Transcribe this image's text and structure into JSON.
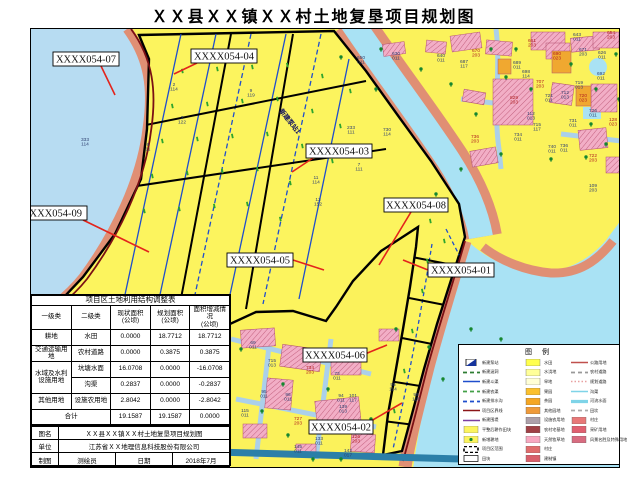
{
  "title": "ＸＸ县ＸＸ镇ＸＸ村土地复垦项目规划图",
  "map": {
    "rotated_note": {
      "text": "新建泵站1",
      "x": 248,
      "y": 82,
      "rot": 52
    },
    "parcel_labels": [
      {
        "text": "XXXX054-07",
        "x": 22,
        "y": 23,
        "w": 66,
        "h": 14,
        "lx1": 70,
        "ly1": 37,
        "lx2": 84,
        "ly2": 66
      },
      {
        "text": "XXXX054-04",
        "x": 160,
        "y": 20,
        "w": 66,
        "h": 14,
        "lx1": 166,
        "ly1": 34,
        "lx2": 143,
        "ly2": 45
      },
      {
        "text": "XXXX054-09",
        "x": -14,
        "y": 177,
        "w": 70,
        "h": 14,
        "lx1": 52,
        "ly1": 191,
        "lx2": 118,
        "ly2": 223
      },
      {
        "text": "XXXX054-03",
        "x": 275,
        "y": 115,
        "w": 66,
        "h": 14,
        "lx1": 282,
        "ly1": 129,
        "lx2": 261,
        "ly2": 143
      },
      {
        "text": "XXXX054-08",
        "x": 353,
        "y": 169,
        "w": 64,
        "h": 14,
        "lx1": 380,
        "ly1": 183,
        "lx2": 348,
        "ly2": 236
      },
      {
        "text": "XXXX054-05",
        "x": 196,
        "y": 224,
        "w": 66,
        "h": 14,
        "lx1": 262,
        "ly1": 231,
        "lx2": 293,
        "ly2": 241
      },
      {
        "text": "XXXX054-01",
        "x": 397,
        "y": 234,
        "w": 66,
        "h": 14,
        "lx1": 397,
        "ly1": 241,
        "lx2": 372,
        "ly2": 231
      },
      {
        "text": "XXXX054-06",
        "x": 272,
        "y": 319,
        "w": 64,
        "h": 14,
        "lx1": 334,
        "ly1": 325,
        "lx2": 356,
        "ly2": 316
      },
      {
        "text": "XXXX054-02",
        "x": 278,
        "y": 391,
        "w": 64,
        "h": 14,
        "lx1": 340,
        "ly1": 392,
        "lx2": 371,
        "ly2": 374
      }
    ],
    "annotations": [
      {
        "x": 54,
        "y": 112,
        "t": "333",
        "b": "114"
      },
      {
        "x": 143,
        "y": 57,
        "t": "2",
        "b": "114"
      },
      {
        "x": 151,
        "y": 90,
        "t": "3",
        "b": "122"
      },
      {
        "x": 117,
        "y": 117,
        "t": "6",
        "b": "11"
      },
      {
        "x": 220,
        "y": 63,
        "t": "9",
        "b": "119"
      },
      {
        "x": 320,
        "y": 100,
        "t": "233",
        "b": "111"
      },
      {
        "x": 328,
        "y": 137,
        "t": "7",
        "b": "111"
      },
      {
        "x": 356,
        "y": 102,
        "t": "730",
        "b": "114"
      },
      {
        "x": 285,
        "y": 150,
        "t": "11",
        "b": "114"
      },
      {
        "x": 287,
        "y": 172,
        "t": "13",
        "b": "152"
      },
      {
        "x": 330,
        "y": 30,
        "t": "650",
        "b": "011"
      },
      {
        "x": 365,
        "y": 26,
        "t": "630",
        "b": "011"
      },
      {
        "x": 410,
        "y": 28,
        "t": "640",
        "b": "011"
      },
      {
        "x": 222,
        "y": 315,
        "t": "69",
        "b": "011"
      },
      {
        "x": 241,
        "y": 333,
        "t": "715",
        "b": "013"
      },
      {
        "x": 279,
        "y": 340,
        "t": "734",
        "b": "203",
        "c": "r"
      },
      {
        "x": 306,
        "y": 346,
        "t": "73",
        "b": "011"
      },
      {
        "x": 233,
        "y": 364,
        "t": "95",
        "b": "011"
      },
      {
        "x": 257,
        "y": 367,
        "t": "96",
        "b": "011"
      },
      {
        "x": 214,
        "y": 383,
        "t": "115",
        "b": "011"
      },
      {
        "x": 267,
        "y": 391,
        "t": "727",
        "b": "203",
        "c": "r"
      },
      {
        "x": 288,
        "y": 411,
        "t": "133",
        "b": "011"
      },
      {
        "x": 267,
        "y": 419,
        "t": "145",
        "b": "011"
      },
      {
        "x": 317,
        "y": 423,
        "t": "142",
        "b": "017"
      },
      {
        "x": 312,
        "y": 379,
        "t": "139",
        "b": "013"
      },
      {
        "x": 322,
        "y": 368,
        "t": "101",
        "b": "117"
      },
      {
        "x": 310,
        "y": 368,
        "t": "94",
        "b": "011"
      },
      {
        "x": 325,
        "y": 409,
        "t": "126",
        "b": "203",
        "c": "r"
      },
      {
        "x": 362,
        "y": 357,
        "t": "95",
        "b": "114"
      },
      {
        "x": 385,
        "y": 367,
        "t": "98",
        "b": "118"
      },
      {
        "x": 546,
        "y": 7,
        "t": "643",
        "b": "011"
      },
      {
        "x": 580,
        "y": 5,
        "t": "654",
        "b": "203",
        "c": "r"
      },
      {
        "x": 501,
        "y": 13,
        "t": "661",
        "b": "203",
        "c": "r"
      },
      {
        "x": 445,
        "y": 23,
        "t": "670",
        "b": "203",
        "c": "r"
      },
      {
        "x": 526,
        "y": 26,
        "t": "690",
        "b": "023",
        "c": "r"
      },
      {
        "x": 552,
        "y": 22,
        "t": "671",
        "b": "203"
      },
      {
        "x": 571,
        "y": 25,
        "t": "626",
        "b": "011"
      },
      {
        "x": 433,
        "y": 34,
        "t": "687",
        "b": "117"
      },
      {
        "x": 486,
        "y": 35,
        "t": "689",
        "b": "011"
      },
      {
        "x": 495,
        "y": 44,
        "t": "698",
        "b": "114"
      },
      {
        "x": 570,
        "y": 46,
        "t": "692",
        "b": "011"
      },
      {
        "x": 509,
        "y": 54,
        "t": "707",
        "b": "203",
        "c": "r"
      },
      {
        "x": 548,
        "y": 55,
        "t": "719",
        "b": "013"
      },
      {
        "x": 552,
        "y": 68,
        "t": "720",
        "b": "023",
        "c": "r"
      },
      {
        "x": 518,
        "y": 68,
        "t": "721",
        "b": "011"
      },
      {
        "x": 534,
        "y": 65,
        "t": "712",
        "b": "013"
      },
      {
        "x": 483,
        "y": 70,
        "t": "829",
        "b": "203",
        "c": "r"
      },
      {
        "x": 562,
        "y": 83,
        "t": "726",
        "b": "011"
      },
      {
        "x": 542,
        "y": 93,
        "t": "731",
        "b": "011"
      },
      {
        "x": 500,
        "y": 86,
        "t": "112",
        "b": "013"
      },
      {
        "x": 506,
        "y": 97,
        "t": "715",
        "b": "117"
      },
      {
        "x": 487,
        "y": 107,
        "t": "734",
        "b": "011"
      },
      {
        "x": 521,
        "y": 119,
        "t": "740",
        "b": "011"
      },
      {
        "x": 533,
        "y": 118,
        "t": "736",
        "b": "011"
      },
      {
        "x": 582,
        "y": 92,
        "t": "128",
        "b": "023",
        "c": "r"
      },
      {
        "x": 444,
        "y": 109,
        "t": "736",
        "b": "203",
        "c": "r"
      },
      {
        "x": 562,
        "y": 128,
        "t": "722",
        "b": "203",
        "c": "r"
      },
      {
        "x": 562,
        "y": 158,
        "t": "109",
        "b": "203"
      }
    ]
  },
  "table": {
    "title": "项目区土地利用结构调整表",
    "headers": [
      "一级类",
      "二级类",
      "现状面积\n(公顷)",
      "规划面积\n(公顷)",
      "面积增减情况\n(公顷)"
    ],
    "rows": [
      {
        "c1": "耕地",
        "span": 1,
        "c2": "水田",
        "v": [
          "0.0000",
          "18.7712",
          "18.7712"
        ]
      },
      {
        "c1": "交通运输用地",
        "span": 1,
        "c2": "农村道路",
        "v": [
          "0.0000",
          "0.3875",
          "0.3875"
        ]
      },
      {
        "c1": "水域及水利设施用地",
        "span": 2,
        "c2": "坑塘水面",
        "v": [
          "16.0708",
          "0.0000",
          "-16.0708"
        ]
      },
      {
        "c1": null,
        "c2": "沟渠",
        "v": [
          "0.2837",
          "0.0000",
          "-0.2837"
        ]
      },
      {
        "c1": "其他用地",
        "span": 1,
        "c2": "设施农用地",
        "v": [
          "2.8042",
          "0.0000",
          "-2.8042"
        ]
      }
    ],
    "total": {
      "label": "合计",
      "v": [
        "19.1587",
        "19.1587",
        "0.0000"
      ]
    }
  },
  "signature": {
    "row1": {
      "label": "图名",
      "value": "ＸＸ县ＸＸ镇ＸＸ村土地复垦项目规划图"
    },
    "row2": {
      "label": "单位",
      "value": "江苏省ＸＸ地理信息科技股份有限公司"
    },
    "row3": {
      "label": "制图",
      "value": "测绘员",
      "label2": "日期",
      "value2": "2018年7月"
    }
  },
  "legend": {
    "title": "图 例",
    "col1": [
      {
        "sym": "pump",
        "color": "#16349C",
        "label": "新建泵站"
      },
      {
        "sym": "dash2",
        "color": "#2E7D32",
        "label": "新建涵洞"
      },
      {
        "sym": "line",
        "color": "#1F4ECC",
        "label": "新建斗渠"
      },
      {
        "sym": "dash2",
        "color": "#43A047",
        "label": "新建农渠"
      },
      {
        "sym": "dash2",
        "color": "#1F4ECC",
        "label": "新建排水沟"
      },
      {
        "sym": "line",
        "color": "#8B1518",
        "label": "项目区界线"
      },
      {
        "sym": "line",
        "color": "#7B3FA0",
        "label": "新建围堤"
      },
      {
        "sym": "swatch",
        "color": "#FCF45E",
        "label": "平整后耕作田块"
      },
      {
        "sym": "swatchdot",
        "color": "#FCF45E",
        "label": "新增耕地"
      },
      {
        "sym": "dashrect",
        "color": "#000000",
        "label": "项目区范围"
      },
      {
        "sym": "rect",
        "color": "#FFFFFF",
        "label": "田块"
      }
    ],
    "col2": [
      {
        "sym": "swatch",
        "color": "#FFFF4D",
        "label": "水田"
      },
      {
        "sym": "swatch",
        "color": "#FFFF99",
        "label": "水浇地"
      },
      {
        "sym": "swatch",
        "color": "#FFFFD6",
        "label": "旱地"
      },
      {
        "sym": "swatch",
        "color": "#FBC02D",
        "label": "果园"
      },
      {
        "sym": "swatch",
        "color": "#F5A623",
        "label": "茶园"
      },
      {
        "sym": "swatch",
        "color": "#EF9A3A",
        "label": "其他园地"
      },
      {
        "sym": "swatch",
        "color": "#ADA0AA",
        "label": "设施农用地"
      },
      {
        "sym": "swatch",
        "color": "#A04045",
        "label": "农村宅基地"
      },
      {
        "sym": "swatch",
        "color": "#F8A8C0",
        "label": "天然牧草地"
      },
      {
        "sym": "swatch",
        "color": "#E06C6C",
        "label": "村庄"
      },
      {
        "sym": "swatch",
        "color": "#D95F6A",
        "label": "建制镇"
      }
    ],
    "col3": [
      {
        "sym": "line",
        "color": "#C0504D",
        "label": "公路用地"
      },
      {
        "sym": "dash2",
        "color": "#999999",
        "label": "农村道路"
      },
      {
        "sym": "crossdash",
        "color": "#E8A0A0",
        "label": "规划道路"
      },
      {
        "sym": "line",
        "color": "#7FD4E8",
        "label": "沟渠"
      },
      {
        "sym": "thickline",
        "color": "#7FD4E8",
        "label": "河流水面"
      },
      {
        "sym": "dash2",
        "color": "#AAAAAA",
        "label": "田坎"
      },
      {
        "sym": "swatch",
        "color": "#E87878",
        "label": "村庄"
      },
      {
        "sym": "swatch",
        "color": "#E06070",
        "label": "采矿用地"
      },
      {
        "sym": "swatch",
        "color": "#D86C80",
        "label": "风景名胜及特殊用地"
      }
    ]
  },
  "colors": {
    "land": "#FBF25B",
    "lake": "#B7DCF2",
    "river": "#A9E2F4",
    "dike": "#E08F74",
    "boundary": "#7A1014",
    "village": "#F2AEC6",
    "orange": "#F0A830",
    "leader": "#E3241C"
  }
}
